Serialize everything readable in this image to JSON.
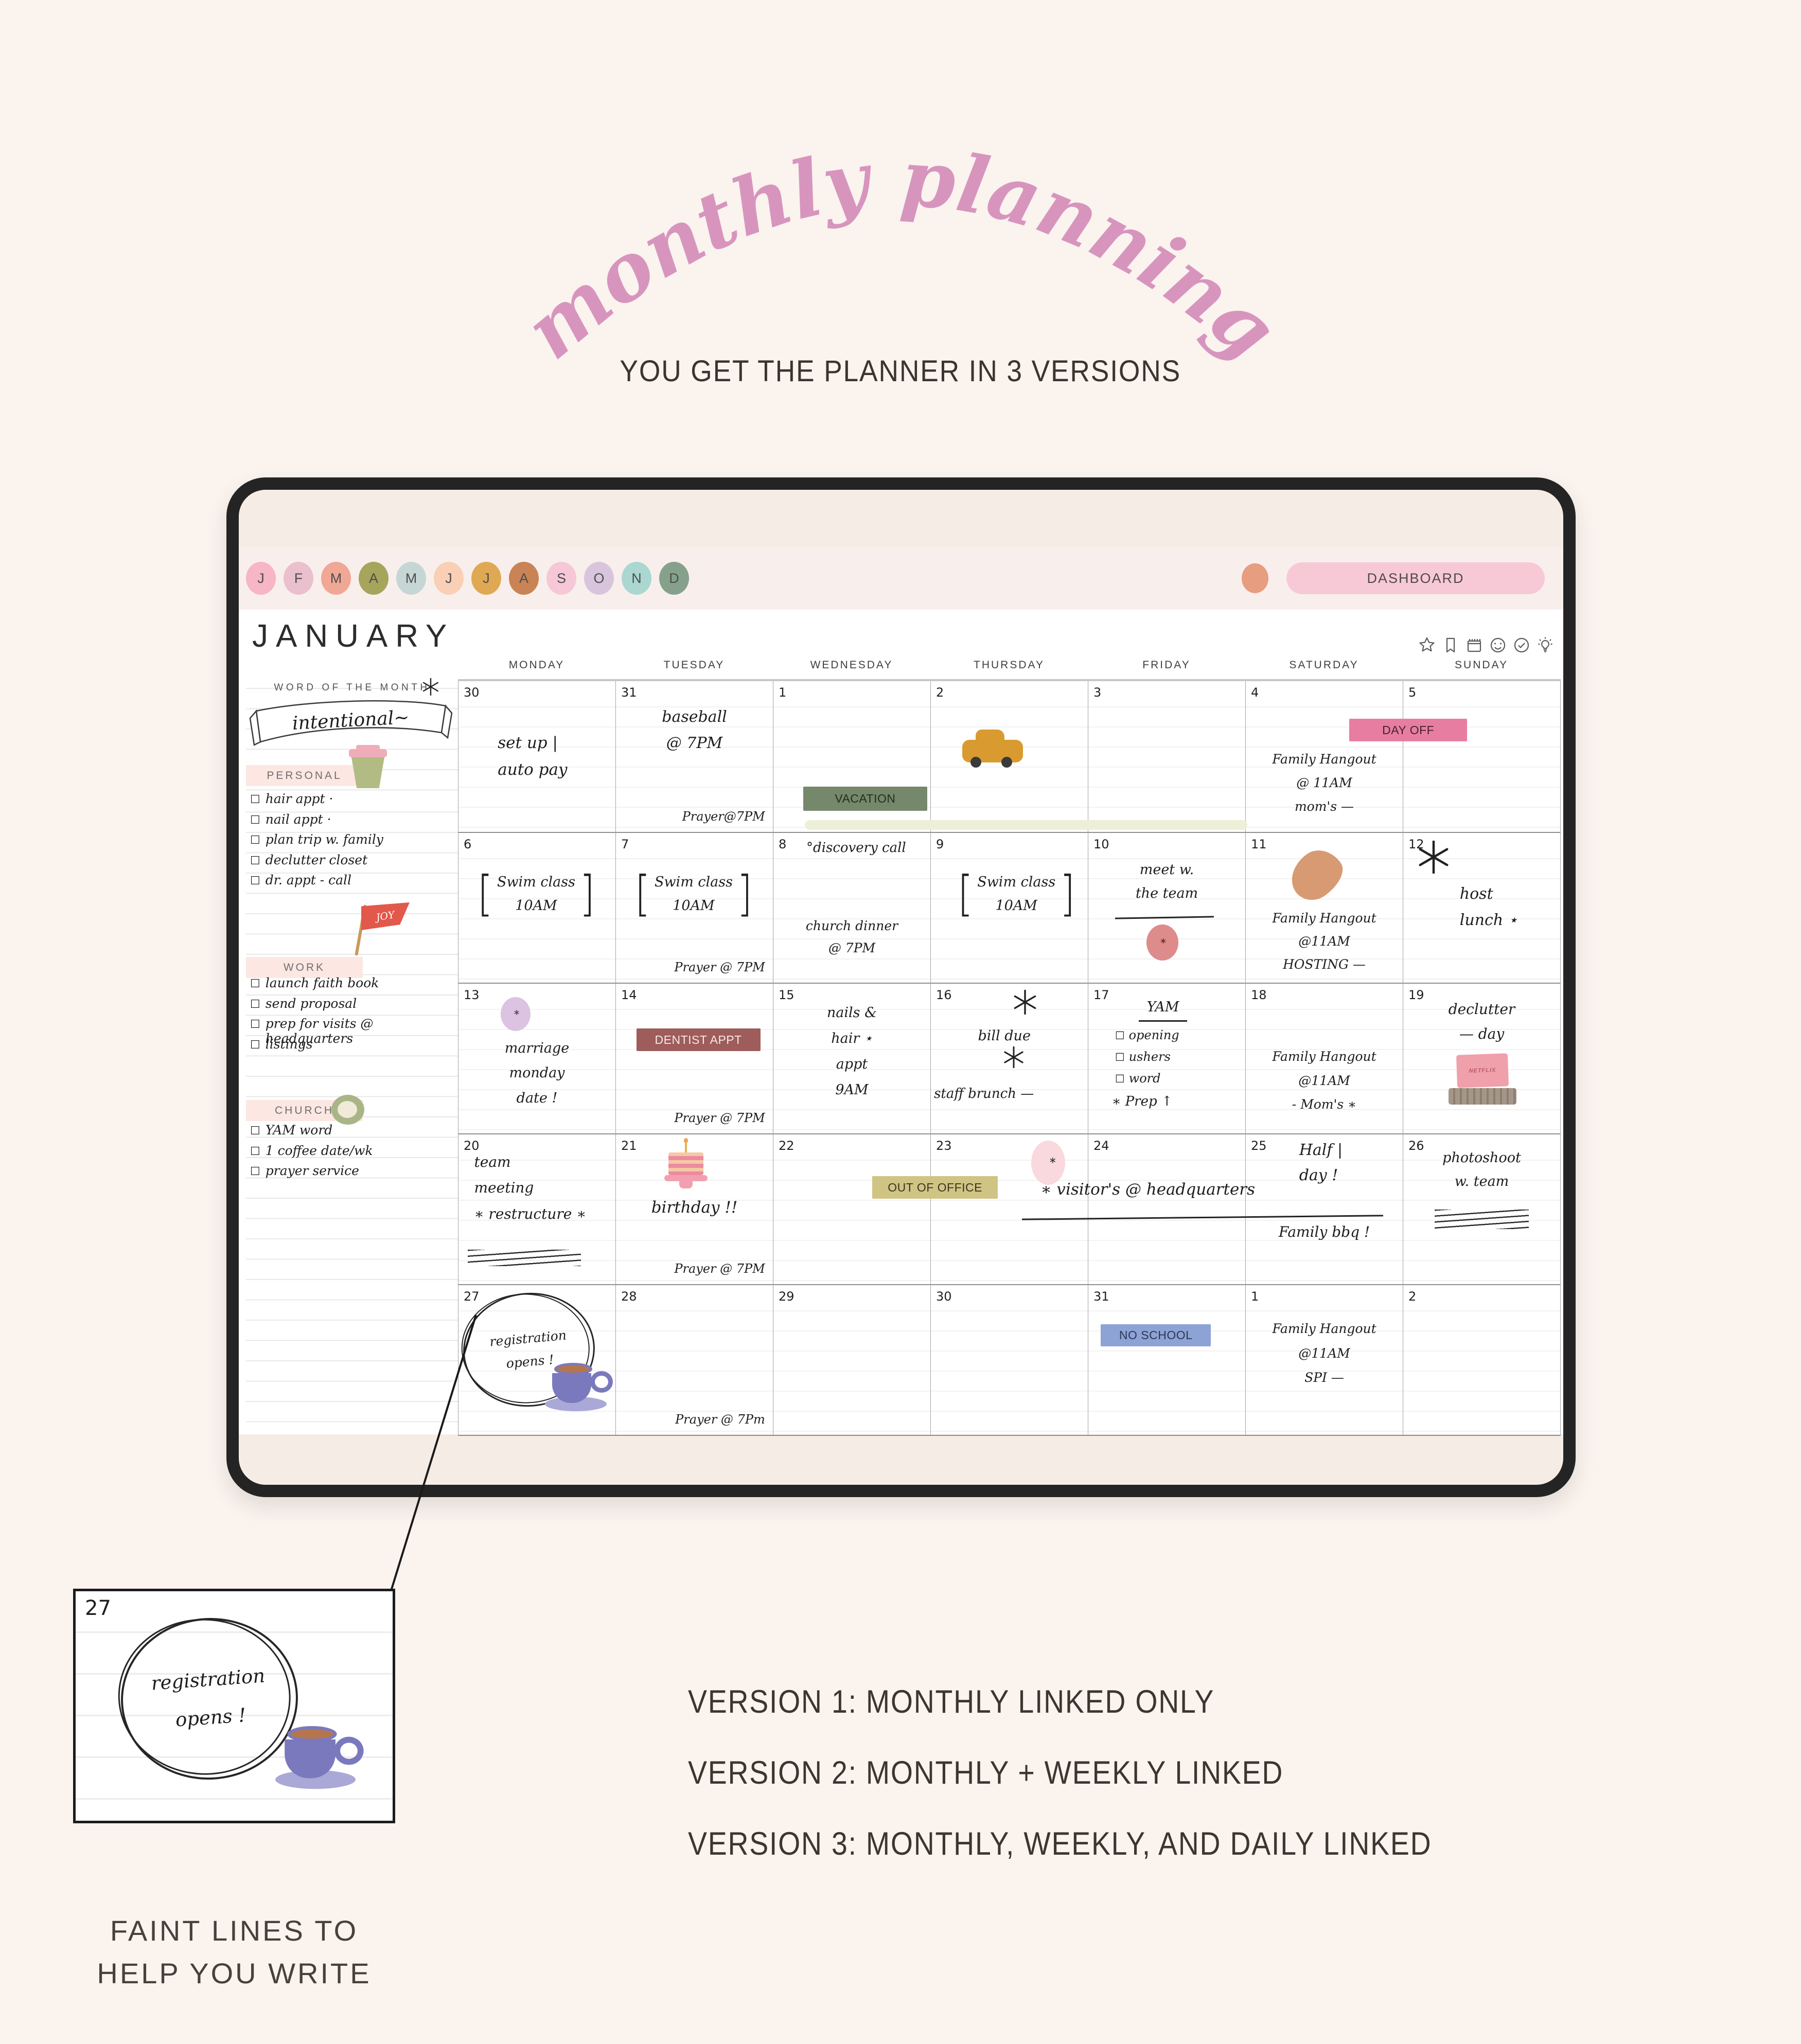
{
  "hero": {
    "title": "monthly planning",
    "subtitle": "YOU GET THE PLANNER IN 3 VERSIONS",
    "title_color": "#d795be"
  },
  "tablet": {
    "month_tabs": [
      {
        "label": "J",
        "color": "#f6b6c3"
      },
      {
        "label": "F",
        "color": "#eabfce"
      },
      {
        "label": "M",
        "color": "#f0a795"
      },
      {
        "label": "A",
        "color": "#a7a45c"
      },
      {
        "label": "M",
        "color": "#c6d6d5"
      },
      {
        "label": "J",
        "color": "#f9cfb5"
      },
      {
        "label": "J",
        "color": "#dfa953"
      },
      {
        "label": "A",
        "color": "#c98354"
      },
      {
        "label": "S",
        "color": "#f6c7d7"
      },
      {
        "label": "O",
        "color": "#d8c5dd"
      },
      {
        "label": "N",
        "color": "#abd7d1"
      },
      {
        "label": "D",
        "color": "#85a18b"
      }
    ],
    "profile_dot_color": "#e69d80",
    "dashboard_label": "DASHBOARD",
    "month_title": "JANUARY",
    "toolbar_icons": [
      "star-icon",
      "bookmark-icon",
      "calendar-icon",
      "smiley-icon",
      "check-circle-icon",
      "bulb-icon"
    ]
  },
  "sidebar": {
    "word_of_month_label": "WORD OF THE MONTH",
    "word": "intentional~",
    "joy_flag_text": "JOY",
    "sections": [
      {
        "title": "PERSONAL",
        "items": [
          "hair appt ·",
          "nail appt ·",
          "plan trip w. family",
          "declutter closet",
          "dr. appt - call"
        ]
      },
      {
        "title": "WORK",
        "items": [
          "launch faith book",
          "send proposal",
          "prep for visits @ headquarters",
          "listings"
        ]
      },
      {
        "title": "CHURCH",
        "items": [
          "YAM word",
          "1 coffee date/wk",
          "prayer service"
        ]
      }
    ]
  },
  "stickers": {
    "laptop_screen_text": "NETFLIX"
  },
  "calendar": {
    "day_headers": [
      "MONDAY",
      "TUESDAY",
      "WEDNESDAY",
      "THURSDAY",
      "FRIDAY",
      "SATURDAY",
      "SUNDAY"
    ],
    "weeks": [
      [
        {
          "day": "30",
          "entries": [
            {
              "k": "hand",
              "t": "set up |\nauto pay",
              "s": "left:25%;top:32%;font-size:31px;"
            }
          ]
        },
        {
          "day": "31",
          "entries": [
            {
              "k": "hand",
              "t": "baseball\n@ 7PM",
              "s": "left:0;right:0;top:15%;text-align:center;font-size:30px;"
            },
            {
              "k": "hand",
              "t": "Prayer@7PM",
              "c": "prayer"
            }
          ]
        },
        {
          "day": "1",
          "entries": [
            {
              "k": "label",
              "t": "VACATION",
              "bg": "#75886b",
              "fg": "#242e1c",
              "s": "left:19%;width:79%;top:70%;height:16%;"
            },
            {
              "k": "hl",
              "s": "left:20%;top:92%;width:282%;height:6.5%;"
            }
          ]
        },
        {
          "day": "2",
          "entries": [
            {
              "k": "sticker",
              "n": "taxi",
              "s": "left:20%;top:32%;"
            }
          ]
        },
        {
          "day": "3",
          "entries": []
        },
        {
          "day": "4",
          "entries": [
            {
              "k": "label",
              "t": "DAY OFF",
              "bg": "#e87da2",
              "fg": "#44232f",
              "s": "left:66%;width:75%;top:25%;height:15%;z-index:4;"
            },
            {
              "k": "hand",
              "t": "Family Hangout\n@ 11AM\nmom's —",
              "s": "left:0;right:0;top:44%;text-align:center;font-size:25px;line-height:1.85;"
            }
          ]
        },
        {
          "day": "5",
          "entries": []
        }
      ],
      [
        {
          "day": "6",
          "entries": [
            {
              "k": "bracket",
              "t": "Swim class\n10AM",
              "s": "left:3%;top:25%;width:93%;"
            }
          ]
        },
        {
          "day": "7",
          "entries": [
            {
              "k": "bracket",
              "t": "Swim class\n10AM",
              "s": "left:3%;top:25%;width:93%;"
            },
            {
              "k": "hand",
              "t": "Prayer @ 7PM",
              "c": "prayer"
            }
          ]
        },
        {
          "day": "8",
          "entries": [
            {
              "k": "hand",
              "t": "°discovery call",
              "s": "left:21%;top:2.5%;font-size:26px;"
            },
            {
              "k": "hand",
              "t": "church dinner\n@ 7PM",
              "s": "left:0;right:0;top:55%;text-align:center;font-size:25px;"
            }
          ]
        },
        {
          "day": "9",
          "entries": [
            {
              "k": "bracket",
              "t": "Swim class\n10AM",
              "s": "left:8%;top:25%;width:93%;"
            }
          ]
        },
        {
          "day": "10",
          "entries": [
            {
              "k": "hand",
              "t": "meet w.\nthe team",
              "s": "left:0;right:0;top:17%;text-align:center;font-size:27px;"
            },
            {
              "k": "uline",
              "s": "left:17%;top:56%;width:63%;transform:rotate(-1deg);"
            },
            {
              "k": "sticker",
              "n": "red-circle",
              "s": "left:37%;top:61%;"
            }
          ]
        },
        {
          "day": "11",
          "entries": [
            {
              "k": "sticker",
              "n": "croissant",
              "s": "left:28%;top:13%;"
            },
            {
              "k": "hand",
              "t": "Family Hangout\n@11AM\nHOSTING —",
              "s": "left:0;right:0;top:49%;text-align:center;font-size:25px;line-height:1.8;"
            }
          ]
        },
        {
          "day": "12",
          "entries": [
            {
              "k": "burst",
              "s": "left:9%;top:5%;"
            },
            {
              "k": "hand",
              "t": "host\nlunch ⋆",
              "s": "left:36%;top:32%;font-size:30px;"
            }
          ]
        }
      ],
      [
        {
          "day": "13",
          "entries": [
            {
              "k": "sticker",
              "n": "lavender-circle",
              "s": "left:27%;top:9%;"
            },
            {
              "k": "hand",
              "t": "marriage\nmonday\ndate !",
              "s": "left:0;right:0;top:35%;text-align:center;font-size:27px;line-height:1.8;"
            }
          ]
        },
        {
          "day": "14",
          "entries": [
            {
              "k": "label",
              "t": "DENTIST APPT",
              "bg": "#9e5c5a",
              "fg": "#f6e8e7",
              "s": "left:13%;width:79%;top:30%;height:15%;"
            },
            {
              "k": "hand",
              "t": "Prayer @ 7PM",
              "c": "prayer"
            }
          ]
        },
        {
          "day": "15",
          "entries": [
            {
              "k": "hand",
              "t": "nails &\nhair ⋆\nappt\n9AM",
              "s": "left:0;right:0;top:11%;text-align:center;font-size:27px;line-height:1.85;"
            }
          ]
        },
        {
          "day": "16",
          "entries": [
            {
              "k": "burst",
              "s": "left:52%;top:4%;width:48px;height:48px;"
            },
            {
              "k": "hand",
              "t": "bill due",
              "s": "left:30%;top:27%;font-size:27px;"
            },
            {
              "k": "burst",
              "s": "left:46%;top:42%;width:42px;height:42px;"
            },
            {
              "k": "hand",
              "t": "staff brunch —",
              "s": "left:2%;top:66%;font-size:26px;white-space:nowrap;"
            }
          ]
        },
        {
          "day": "17",
          "entries": [
            {
              "k": "hand",
              "t": "YAM",
              "s": "left:32%;top:8%;font-size:27px;border-bottom:3px solid #222;padding:0 16px 2px;"
            },
            {
              "k": "klist",
              "items": [
                "opening",
                "ushers",
                "word"
              ],
              "s": "left:17%;top:27%;"
            },
            {
              "k": "hand",
              "t": "∗ Prep ↑",
              "s": "left:15%;top:71%;font-size:26px;"
            }
          ]
        },
        {
          "day": "18",
          "entries": [
            {
              "k": "hand",
              "t": "Family Hangout\n@11AM\n- Mom's ∗",
              "s": "left:0;right:0;top:41%;text-align:center;font-size:25px;line-height:1.85;"
            }
          ]
        },
        {
          "day": "19",
          "entries": [
            {
              "k": "hand",
              "t": "declutter\n— day",
              "s": "left:0;right:0;top:9%;text-align:center;font-size:28px;"
            },
            {
              "k": "sticker",
              "n": "laptop",
              "s": "left:29%;top:47%;"
            }
          ]
        }
      ],
      [
        {
          "day": "20",
          "entries": [
            {
              "k": "hand",
              "t": "team\nmeeting\n∗ restructure ∗",
              "s": "left:10%;top:10%;font-size:28px;line-height:1.8;"
            },
            {
              "k": "scrib",
              "s": "left:6%;top:77%;width:72%;height:32px;"
            }
          ]
        },
        {
          "day": "21",
          "entries": [
            {
              "k": "sticker",
              "n": "cake",
              "s": "left:30%;top:3%;"
            },
            {
              "k": "hand",
              "t": "birthday !!",
              "s": "left:0;right:0;top:40%;text-align:center;font-size:31px;"
            },
            {
              "k": "hand",
              "t": "Prayer @ 7PM",
              "c": "prayer"
            }
          ]
        },
        {
          "day": "22",
          "entries": [
            {
              "k": "label",
              "t": "OUT OF OFFICE",
              "bg": "#cfc484",
              "fg": "#3a351e",
              "s": "left:63%;width:80%;top:28%;height:15%;z-index:4;"
            }
          ]
        },
        {
          "day": "23",
          "entries": [
            {
              "k": "sticker",
              "n": "pink-blob",
              "s": "left:64%;top:4%;"
            },
            {
              "k": "hand",
              "t": "∗ visitor's @ headquarters",
              "s": "left:70%;top:28%;width:235%;font-size:31px;white-space:nowrap;z-index:5;"
            },
            {
              "k": "uline",
              "s": "left:58%;top:55%;width:230%;transform:rotate(-0.6deg);z-index:5;"
            }
          ]
        },
        {
          "day": "24",
          "entries": []
        },
        {
          "day": "25",
          "entries": [
            {
              "k": "hand",
              "t": "Half |\nday !",
              "s": "left:34%;top:2%;font-size:30px;line-height:1.65;"
            },
            {
              "k": "hand",
              "t": "Family bbq !",
              "s": "left:0;right:0;top:57%;text-align:center;font-size:28px;"
            }
          ]
        },
        {
          "day": "26",
          "entries": [
            {
              "k": "hand",
              "t": "photoshoot\nw. team",
              "s": "left:0;right:0;top:8%;text-align:center;font-size:27px;"
            },
            {
              "k": "scrib",
              "s": "left:20%;top:50%;width:60%;height:38px;"
            }
          ]
        }
      ],
      [
        {
          "day": "27",
          "entries": [
            {
              "k": "ring",
              "t": "registration\nopens !",
              "s": "left:3%;top:5%;width:82%;height:74%;"
            },
            {
              "k": "sticker",
              "n": "purple-cup",
              "s": "left:55%;top:52%;z-index:3;"
            }
          ]
        },
        {
          "day": "28",
          "entries": [
            {
              "k": "hand",
              "t": "Prayer @ 7Pm",
              "c": "prayer"
            }
          ]
        },
        {
          "day": "29",
          "entries": []
        },
        {
          "day": "30",
          "entries": []
        },
        {
          "day": "31",
          "entries": [
            {
              "k": "label",
              "t": "NO SCHOOL",
              "bg": "#8da3d5",
              "fg": "#2c3756",
              "s": "left:8%;width:70%;top:26%;height:15%;"
            }
          ]
        },
        {
          "day": "1",
          "entries": [
            {
              "k": "hand",
              "t": "Family Hangout\n@11AM\nSPI —",
              "s": "left:0;right:0;top:21%;text-align:center;font-size:25px;line-height:1.9;"
            }
          ]
        },
        {
          "day": "2",
          "entries": []
        }
      ]
    ]
  },
  "callout": {
    "day": "27",
    "note_line1": "registration",
    "note_line2": "opens !",
    "caption": "FAINT LINES TO\nHELP YOU WRITE"
  },
  "versions": [
    "VERSION 1: MONTHLY LINKED ONLY",
    "VERSION 2: MONTHLY + WEEKLY LINKED",
    "VERSION 3: MONTHLY, WEEKLY, AND DAILY LINKED"
  ]
}
